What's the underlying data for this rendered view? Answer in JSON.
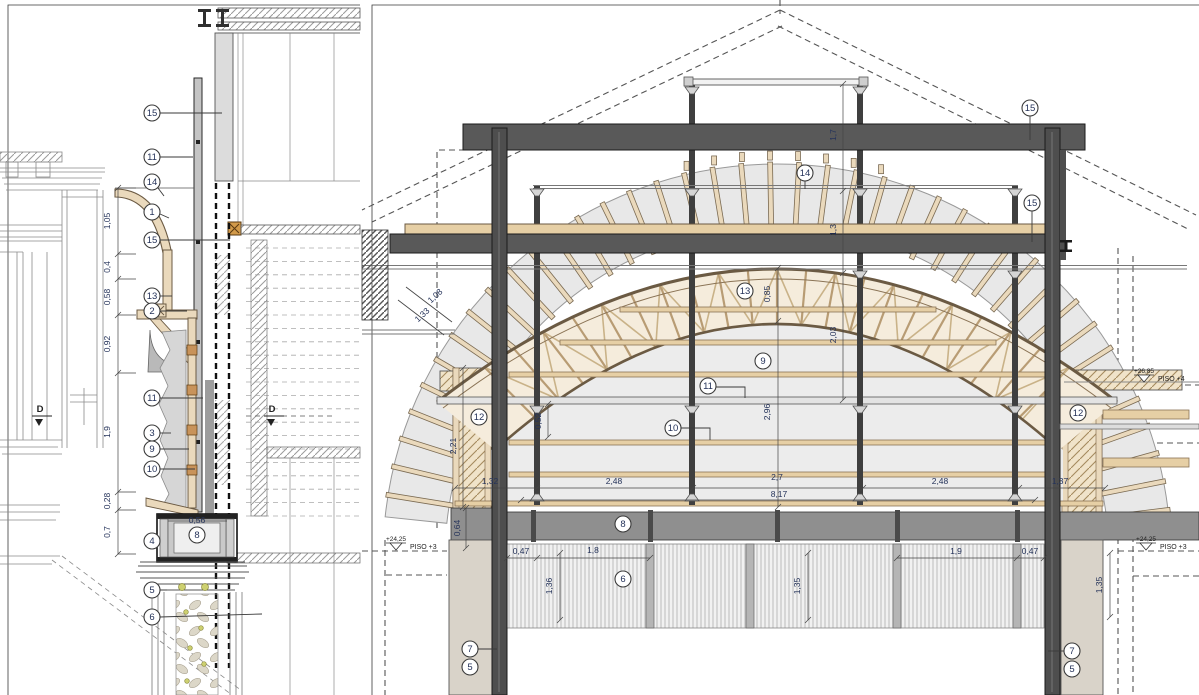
{
  "drawing": {
    "kind": "architectural construction details",
    "left_view_label": "vertical section detail",
    "right_view_label": "cross section of vaulted roof structure"
  },
  "colors": {
    "steel_dark": "#595959",
    "wood_tan": "#e6cfa5",
    "wood_edge": "#6b5a43",
    "hatch_tan_bg": "#f0e3c9",
    "fan_gray": "#e8e8e8",
    "annotation_text": "#25335a",
    "pier_beige": "#d9d3c9",
    "dot_yellow": "#cdd070"
  },
  "left_panel": {
    "callouts": [
      {
        "label": "15",
        "x": 152,
        "y": 113,
        "pts": [
          [
            160,
            113
          ],
          [
            222,
            113
          ]
        ]
      },
      {
        "label": "11",
        "x": 152,
        "y": 157,
        "pts": [
          [
            160,
            157
          ],
          [
            193,
            157
          ]
        ]
      },
      {
        "label": "14",
        "x": 152,
        "y": 182,
        "pts": [
          [
            158,
            188
          ],
          [
            164,
            196
          ]
        ]
      },
      {
        "label": "1",
        "x": 152,
        "y": 212,
        "pts": [
          [
            160,
            214
          ],
          [
            169,
            218
          ]
        ]
      },
      {
        "label": "15",
        "x": 152,
        "y": 240,
        "pts": [
          [
            160,
            240
          ],
          [
            230,
            240
          ]
        ]
      },
      {
        "label": "13",
        "x": 152,
        "y": 296,
        "pts": [
          [
            160,
            296
          ],
          [
            172,
            296
          ]
        ]
      },
      {
        "label": "2",
        "x": 152,
        "y": 311,
        "pts": [
          [
            160,
            311
          ],
          [
            187,
            311
          ]
        ]
      },
      {
        "label": "11",
        "x": 152,
        "y": 398,
        "pts": [
          [
            160,
            398
          ],
          [
            203,
            398
          ]
        ]
      },
      {
        "label": "3",
        "x": 152,
        "y": 433,
        "pts": [
          [
            160,
            433
          ],
          [
            171,
            433
          ]
        ]
      },
      {
        "label": "9",
        "x": 152,
        "y": 449,
        "pts": [
          [
            160,
            449
          ],
          [
            189,
            449
          ]
        ]
      },
      {
        "label": "10",
        "x": 152,
        "y": 469,
        "pts": [
          [
            160,
            469
          ],
          [
            195,
            469
          ]
        ]
      },
      {
        "label": "4",
        "x": 152,
        "y": 541,
        "pts": [
          [
            160,
            541
          ],
          [
            158,
            541
          ]
        ]
      },
      {
        "label": "8",
        "x": 197,
        "y": 535
      },
      {
        "label": "5",
        "x": 152,
        "y": 590,
        "pts": [
          [
            160,
            590
          ],
          [
            167,
            590
          ]
        ]
      },
      {
        "label": "6",
        "x": 152,
        "y": 617,
        "pts": [
          [
            160,
            617
          ],
          [
            262,
            614
          ]
        ]
      }
    ],
    "dims": [
      {
        "t": "1,05",
        "x": 110,
        "y": 221,
        "r": -90
      },
      {
        "t": "0,4",
        "x": 110,
        "y": 267,
        "r": -90
      },
      {
        "t": "0,58",
        "x": 110,
        "y": 297,
        "r": -90
      },
      {
        "t": "0,92",
        "x": 110,
        "y": 344,
        "r": -90
      },
      {
        "t": "1,9",
        "x": 110,
        "y": 432,
        "r": -90
      },
      {
        "t": "0,28",
        "x": 110,
        "y": 501,
        "r": -90
      },
      {
        "t": "0,7",
        "x": 110,
        "y": 532,
        "r": -90
      },
      {
        "t": "0,56",
        "x": 197,
        "y": 523
      }
    ],
    "section_markers": [
      {
        "label": "D",
        "x": 40,
        "y": 412,
        "dash": false
      },
      {
        "label": "D",
        "x": 272,
        "y": 412,
        "dash": true
      }
    ]
  },
  "right_panel": {
    "callouts": [
      {
        "label": "15",
        "x": 1030,
        "y": 108,
        "pts": [
          [
            1030,
            116
          ],
          [
            1030,
            140
          ]
        ]
      },
      {
        "label": "14",
        "x": 805,
        "y": 173,
        "pts": [
          [
            805,
            181
          ],
          [
            805,
            189
          ]
        ]
      },
      {
        "label": "15",
        "x": 1032,
        "y": 203,
        "pts": [
          [
            1032,
            211
          ],
          [
            1032,
            242
          ]
        ]
      },
      {
        "label": "13",
        "x": 745,
        "y": 291
      },
      {
        "label": "9",
        "x": 763,
        "y": 361
      },
      {
        "label": "11",
        "x": 708,
        "y": 386,
        "pts": [
          [
            716,
            387
          ],
          [
            745,
            387
          ],
          [
            745,
            398
          ]
        ]
      },
      {
        "label": "10",
        "x": 673,
        "y": 428,
        "pts": [
          [
            681,
            428
          ],
          [
            710,
            428
          ],
          [
            710,
            440
          ]
        ]
      },
      {
        "label": "12",
        "x": 479,
        "y": 417
      },
      {
        "label": "12",
        "x": 1078,
        "y": 413
      },
      {
        "label": "8",
        "x": 623,
        "y": 524
      },
      {
        "label": "6",
        "x": 623,
        "y": 579
      },
      {
        "label": "7",
        "x": 470,
        "y": 649,
        "pts": [
          [
            478,
            649
          ],
          [
            497,
            649
          ]
        ]
      },
      {
        "label": "5",
        "x": 470,
        "y": 667
      },
      {
        "label": "7",
        "x": 1072,
        "y": 651,
        "pts": [
          [
            1064,
            651
          ],
          [
            1048,
            651
          ]
        ]
      },
      {
        "label": "5",
        "x": 1072,
        "y": 669
      }
    ],
    "dims": [
      {
        "t": "1,7",
        "x": 836,
        "y": 135,
        "r": -90
      },
      {
        "t": "1,3",
        "x": 836,
        "y": 230,
        "r": -90
      },
      {
        "t": "2,03",
        "x": 836,
        "y": 335,
        "r": -90
      },
      {
        "t": "0,85",
        "x": 770,
        "y": 294,
        "r": -90
      },
      {
        "t": "2,96",
        "x": 770,
        "y": 412,
        "r": -90
      },
      {
        "t": "0,52",
        "x": 541,
        "y": 421,
        "r": -90
      },
      {
        "t": "2,21",
        "x": 456,
        "y": 446,
        "r": -90
      },
      {
        "t": "0,64",
        "x": 460,
        "y": 528,
        "r": -90
      },
      {
        "t": "1,08",
        "x": 437,
        "y": 298,
        "r": -43
      },
      {
        "t": "1,33",
        "x": 424,
        "y": 317,
        "r": -43
      },
      {
        "t": "1,32",
        "x": 490,
        "y": 484
      },
      {
        "t": "2,48",
        "x": 614,
        "y": 484
      },
      {
        "t": "2,7",
        "x": 777,
        "y": 480
      },
      {
        "t": "8,17",
        "x": 779,
        "y": 497
      },
      {
        "t": "2,48",
        "x": 940,
        "y": 484
      },
      {
        "t": "1,37",
        "x": 1060,
        "y": 484
      },
      {
        "t": "0,47",
        "x": 521,
        "y": 554
      },
      {
        "t": "1,8",
        "x": 593,
        "y": 553
      },
      {
        "t": "1,9",
        "x": 956,
        "y": 554
      },
      {
        "t": "0,47",
        "x": 1030,
        "y": 554
      },
      {
        "t": "1,36",
        "x": 552,
        "y": 586,
        "r": -90
      },
      {
        "t": "1,35",
        "x": 800,
        "y": 586,
        "r": -90
      },
      {
        "t": "1,35",
        "x": 1102,
        "y": 585,
        "r": -90
      }
    ],
    "elevation_markers": [
      {
        "value": "+24,25",
        "floor": "PISO +3",
        "x": 386,
        "y": 538
      },
      {
        "value": "+24,25",
        "floor": "PISO +3",
        "x": 1136,
        "y": 538
      },
      {
        "value": "+26,85",
        "floor": "PISO +4",
        "x": 1134,
        "y": 370
      }
    ]
  }
}
